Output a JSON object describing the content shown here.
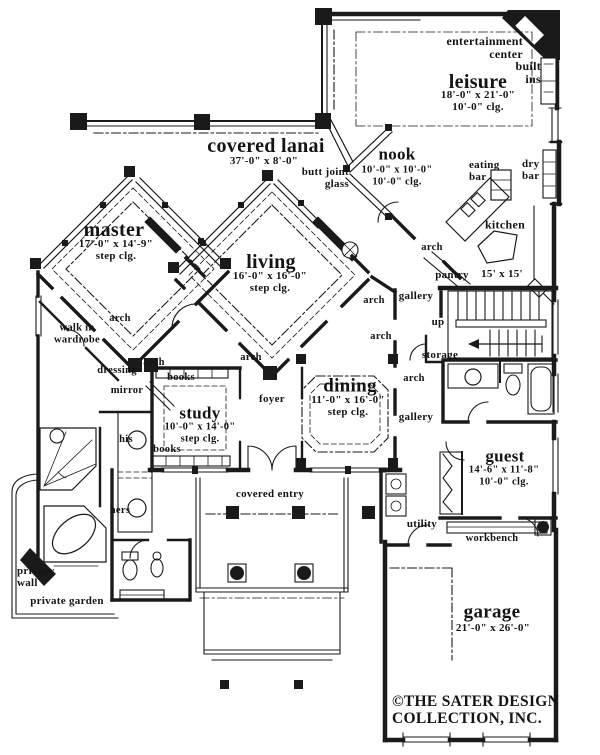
{
  "document": {
    "type": "architectural floor plan",
    "copyright_line1": "©THE SATER DESIGN",
    "copyright_line2": "COLLECTION, INC."
  },
  "colors": {
    "ink": "#1a1a1a",
    "paper": "#ffffff"
  },
  "rooms": [
    {
      "name": "leisure",
      "dims": "18'-0\" x 21'-0\"",
      "ceiling": "10'-0\" clg."
    },
    {
      "name": "covered lanai",
      "dims": "37'-0\" x 8'-0\"",
      "ceiling": ""
    },
    {
      "name": "nook",
      "dims": "10'-0\" x 10'-0\"",
      "ceiling": "10'-0\" clg."
    },
    {
      "name": "kitchen",
      "dims": "15' x 15'",
      "ceiling": ""
    },
    {
      "name": "master",
      "dims": "17'-0\" x 14'-9\"",
      "ceiling": "step clg."
    },
    {
      "name": "living",
      "dims": "16'-0\" x 16'-0\"",
      "ceiling": "step clg."
    },
    {
      "name": "study",
      "dims": "10'-0\" x 14'-0\"",
      "ceiling": "step clg."
    },
    {
      "name": "dining",
      "dims": "11'-0\" x 16'-0\"",
      "ceiling": "step clg."
    },
    {
      "name": "guest",
      "dims": "14'-6\" x 11'-8\"",
      "ceiling": "10'-0\" clg."
    },
    {
      "name": "garage",
      "dims": "21'-0\" x 26'-0\"",
      "ceiling": ""
    }
  ],
  "labels": [
    {
      "id": "entertainment-center",
      "x": 523,
      "y": 48,
      "size": 12,
      "align": "right",
      "lines": [
        "entertainment",
        "center"
      ]
    },
    {
      "id": "built-ins",
      "x": 541,
      "y": 73,
      "size": 12,
      "align": "right",
      "lines": [
        "built",
        "ins"
      ]
    },
    {
      "id": "leisure-title",
      "x": 478,
      "y": 82,
      "size": 20,
      "align": "center",
      "lines": [
        "leisure"
      ]
    },
    {
      "id": "leisure-dims",
      "x": 478,
      "y": 101,
      "size": 11,
      "align": "center",
      "lines": [
        "18'-0\" x 21'-0\"",
        "10'-0\" clg."
      ]
    },
    {
      "id": "covered-lanai-title",
      "x": 266,
      "y": 146,
      "size": 20,
      "align": "center",
      "lines": [
        "covered lanai"
      ]
    },
    {
      "id": "covered-lanai-dim",
      "x": 264,
      "y": 161,
      "size": 11,
      "align": "center",
      "lines": [
        "37'-0\" x 8'-0\""
      ]
    },
    {
      "id": "butt-joint-glass",
      "x": 349,
      "y": 178,
      "size": 11,
      "align": "right",
      "lines": [
        "butt joint",
        "glass"
      ]
    },
    {
      "id": "nook-title",
      "x": 397,
      "y": 155,
      "size": 17,
      "align": "center",
      "lines": [
        "nook"
      ]
    },
    {
      "id": "nook-dims",
      "x": 397,
      "y": 176,
      "size": 10.5,
      "align": "center",
      "lines": [
        "10'-0\" x 10'-0\"",
        "10'-0\" clg."
      ]
    },
    {
      "id": "eating-bar",
      "x": 469,
      "y": 171,
      "size": 11,
      "align": "left",
      "lines": [
        "eating",
        "bar"
      ]
    },
    {
      "id": "dry-bar",
      "x": 522,
      "y": 170,
      "size": 11,
      "align": "left",
      "lines": [
        "dry",
        "bar"
      ]
    },
    {
      "id": "kitchen",
      "x": 505,
      "y": 225,
      "size": 12,
      "align": "center",
      "lines": [
        "kitchen"
      ]
    },
    {
      "id": "pantry",
      "x": 452,
      "y": 275,
      "size": 11,
      "align": "center",
      "lines": [
        "pantry"
      ]
    },
    {
      "id": "kitchen-dim",
      "x": 502,
      "y": 274,
      "size": 11,
      "align": "center",
      "lines": [
        "15' x 15'"
      ]
    },
    {
      "id": "master-title",
      "x": 114,
      "y": 230,
      "size": 20,
      "align": "center",
      "lines": [
        "master"
      ]
    },
    {
      "id": "master-dims",
      "x": 116,
      "y": 250,
      "size": 11,
      "align": "center",
      "lines": [
        "17'-0\" x 14'-9\"",
        "step clg."
      ]
    },
    {
      "id": "walk-in-wardrobe",
      "x": 77,
      "y": 334,
      "size": 10.5,
      "align": "center",
      "lines": [
        "walk in",
        "wardrobe"
      ]
    },
    {
      "id": "arch-master",
      "x": 120,
      "y": 319,
      "size": 10.5,
      "align": "center",
      "lines": [
        "arch"
      ]
    },
    {
      "id": "living-title",
      "x": 271,
      "y": 262,
      "size": 20,
      "align": "center",
      "lines": [
        "living"
      ]
    },
    {
      "id": "living-dims",
      "x": 270,
      "y": 282,
      "size": 11,
      "align": "center",
      "lines": [
        "16'-0\" x 16'-0\"",
        "step clg."
      ]
    },
    {
      "id": "arch-gallery-upper",
      "x": 374,
      "y": 301,
      "size": 10.5,
      "align": "center",
      "lines": [
        "arch"
      ]
    },
    {
      "id": "gallery-upper",
      "x": 416,
      "y": 296,
      "size": 11,
      "align": "center",
      "lines": [
        "gallery"
      ]
    },
    {
      "id": "arch-gallery-mid",
      "x": 381,
      "y": 337,
      "size": 10.5,
      "align": "center",
      "lines": [
        "arch"
      ]
    },
    {
      "id": "up",
      "x": 438,
      "y": 322,
      "size": 11,
      "align": "center",
      "lines": [
        "up"
      ]
    },
    {
      "id": "storage",
      "x": 440,
      "y": 355,
      "size": 11,
      "align": "center",
      "lines": [
        "storage"
      ]
    },
    {
      "id": "arch-foyer",
      "x": 251,
      "y": 358,
      "size": 10.5,
      "align": "center",
      "lines": [
        "arch"
      ]
    },
    {
      "id": "arch-study",
      "x": 154,
      "y": 363,
      "size": 10.5,
      "align": "center",
      "lines": [
        "arch"
      ]
    },
    {
      "id": "books-top",
      "x": 181,
      "y": 378,
      "size": 10.5,
      "align": "center",
      "lines": [
        "books"
      ]
    },
    {
      "id": "dressing",
      "x": 117,
      "y": 371,
      "size": 10.5,
      "align": "center",
      "lines": [
        "dressing"
      ]
    },
    {
      "id": "mirror",
      "x": 127,
      "y": 391,
      "size": 10.5,
      "align": "center",
      "lines": [
        "mirror"
      ]
    },
    {
      "id": "study-title",
      "x": 200,
      "y": 414,
      "size": 17,
      "align": "center",
      "lines": [
        "study"
      ]
    },
    {
      "id": "study-dims",
      "x": 200,
      "y": 433,
      "size": 10.5,
      "align": "center",
      "lines": [
        "10'-0\" x 14'-0\"",
        "step clg."
      ]
    },
    {
      "id": "books-bottom",
      "x": 167,
      "y": 450,
      "size": 10.5,
      "align": "center",
      "lines": [
        "books"
      ]
    },
    {
      "id": "his",
      "x": 126,
      "y": 440,
      "size": 10.5,
      "align": "center",
      "lines": [
        "his"
      ]
    },
    {
      "id": "hers",
      "x": 120,
      "y": 511,
      "size": 10.5,
      "align": "center",
      "lines": [
        "hers"
      ]
    },
    {
      "id": "foyer",
      "x": 272,
      "y": 399,
      "size": 11,
      "align": "center",
      "lines": [
        "foyer"
      ]
    },
    {
      "id": "dining-title",
      "x": 350,
      "y": 387,
      "size": 19,
      "align": "center",
      "lines": [
        "dining"
      ]
    },
    {
      "id": "dining-dims",
      "x": 348,
      "y": 406,
      "size": 11,
      "align": "center",
      "lines": [
        "11'-0\" x 16'-0\"",
        "step clg."
      ]
    },
    {
      "id": "arch-gallery-lower",
      "x": 414,
      "y": 379,
      "size": 10.5,
      "align": "center",
      "lines": [
        "arch"
      ]
    },
    {
      "id": "gallery-lower",
      "x": 416,
      "y": 417,
      "size": 11,
      "align": "center",
      "lines": [
        "gallery"
      ]
    },
    {
      "id": "arch-kitchen",
      "x": 432,
      "y": 248,
      "size": 10.5,
      "align": "center",
      "lines": [
        "arch"
      ]
    },
    {
      "id": "guest-title",
      "x": 505,
      "y": 457,
      "size": 17,
      "align": "center",
      "lines": [
        "guest"
      ]
    },
    {
      "id": "guest-dims",
      "x": 504,
      "y": 476,
      "size": 10.5,
      "align": "center",
      "lines": [
        "14'-6\" x 11'-8\"",
        "10'-0\" clg."
      ]
    },
    {
      "id": "covered-entry",
      "x": 270,
      "y": 494,
      "size": 11,
      "align": "center",
      "lines": [
        "covered entry"
      ]
    },
    {
      "id": "utility",
      "x": 422,
      "y": 524,
      "size": 11,
      "align": "center",
      "lines": [
        "utility"
      ]
    },
    {
      "id": "workbench",
      "x": 492,
      "y": 539,
      "size": 10.5,
      "align": "center",
      "lines": [
        "workbench"
      ]
    },
    {
      "id": "privacy-wall",
      "x": 17,
      "y": 577,
      "size": 11,
      "align": "left",
      "lines": [
        "privacy",
        "wall"
      ]
    },
    {
      "id": "private-garden",
      "x": 67,
      "y": 601,
      "size": 11,
      "align": "center",
      "lines": [
        "private garden"
      ]
    },
    {
      "id": "garage-title",
      "x": 492,
      "y": 613,
      "size": 19,
      "align": "center",
      "lines": [
        "garage"
      ]
    },
    {
      "id": "garage-dim",
      "x": 493,
      "y": 628,
      "size": 11,
      "align": "center",
      "lines": [
        "21'-0\" x 26'-0\""
      ]
    },
    {
      "id": "copyright",
      "x": 392,
      "y": 710,
      "size": 15.5,
      "align": "left",
      "lines": [
        "©THE SATER DESIGN",
        "COLLECTION, INC."
      ]
    }
  ]
}
